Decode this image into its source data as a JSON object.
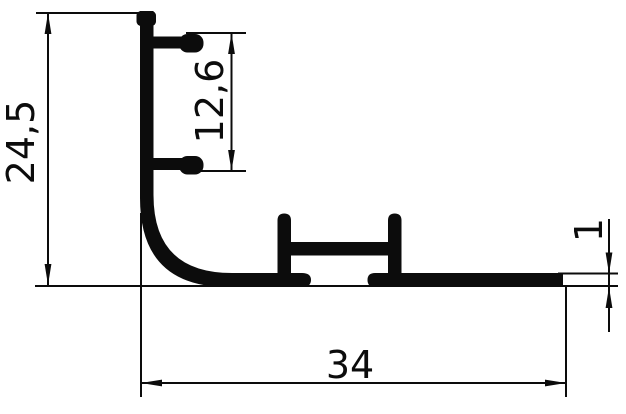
{
  "drawing": {
    "background_color": "#ffffff",
    "ink_color": "#0c0c0c",
    "dimensions": {
      "overall_height": "24,5",
      "flange_spacing": "12,6",
      "base_thickness": "1",
      "overall_width": "34"
    }
  }
}
